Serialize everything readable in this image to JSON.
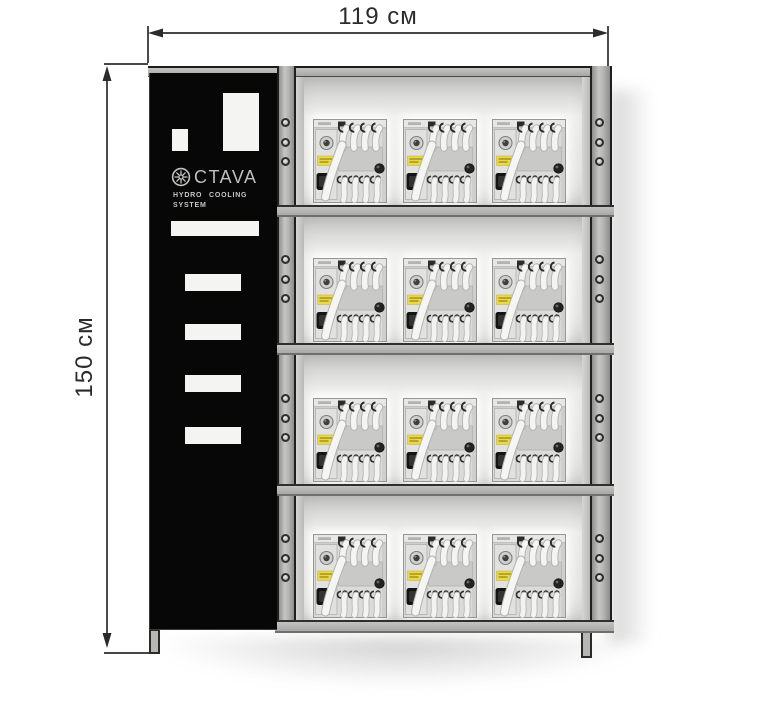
{
  "figure": {
    "type": "product-dimension-diagram",
    "dimensions": {
      "width_label": "119 см",
      "height_label": "150 см"
    },
    "cabinet": {
      "brand_name": "OCTAVA",
      "brand_logo_text": "CTAVA",
      "tagline_line1": "HYDRO COOLING",
      "tagline_line2": "SYSTEM",
      "shelf_count": 4,
      "units_per_shelf": 3,
      "total_units": 12
    },
    "colors": {
      "frame_gray": "#b2b2b0",
      "panel_black": "#070707",
      "interior_light": "#ebebe9",
      "miner_body": "#dbdbd9",
      "warning_label_yellow": "#ecd843",
      "dimension_ink": "#2b2b2b",
      "background": "#ffffff"
    }
  }
}
